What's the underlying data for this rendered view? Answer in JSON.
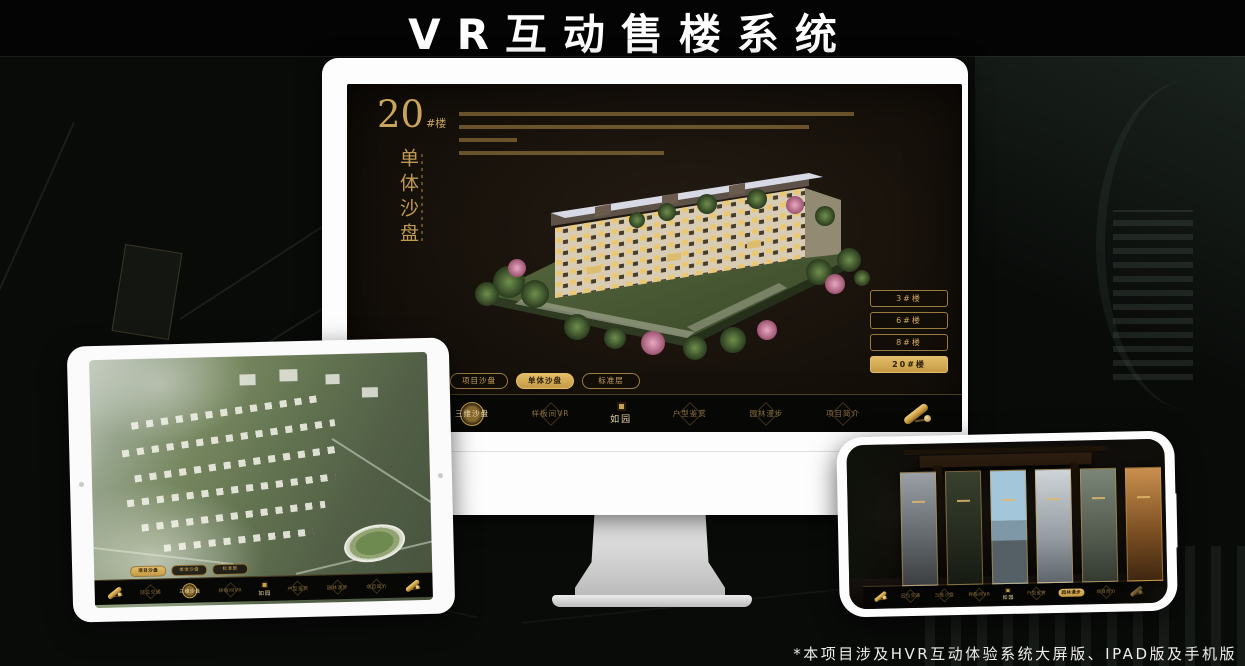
{
  "header": {
    "title": "VR互动售楼系统"
  },
  "footer": {
    "note": "*本项目涉及HVR互动体验系统大屏版、IPAD版及手机版"
  },
  "nav": {
    "logo": "如园",
    "items": [
      "区位交通",
      "三维沙盘",
      "样板间VR",
      "户型鉴赏",
      "园林漫步",
      "项目简介"
    ]
  },
  "desktop_app": {
    "block_title": {
      "number": "20",
      "suffix": "#楼"
    },
    "subtitle": "单体沙盘",
    "floor_buttons": [
      {
        "label": "3#楼",
        "active": false
      },
      {
        "label": "6#楼",
        "active": false
      },
      {
        "label": "8#楼",
        "active": false
      },
      {
        "label": "20#楼",
        "active": true
      }
    ],
    "mode_tabs": [
      {
        "label": "项目沙盘",
        "active": false
      },
      {
        "label": "单体沙盘",
        "active": true
      },
      {
        "label": "标准层",
        "active": false
      }
    ],
    "active_nav": "三维沙盘"
  },
  "tablet_app": {
    "mode_tabs": [
      {
        "label": "项目沙盘",
        "active": true
      },
      {
        "label": "单体沙盘",
        "active": false
      },
      {
        "label": "标准层",
        "active": false
      }
    ],
    "active_nav": "三维沙盘"
  },
  "phone_app": {
    "active_nav": "园林漫步"
  },
  "colors": {
    "gold": "#c9a45c",
    "gold_active_bg": "#d2a654",
    "screen_bg": "#17110b",
    "nav_bg": "#070706"
  }
}
